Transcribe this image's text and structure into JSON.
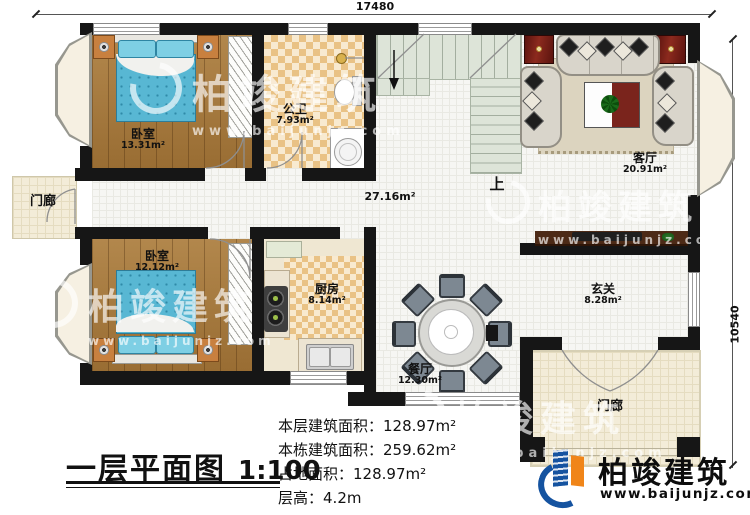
{
  "dimensions": {
    "top": "17480",
    "right": "10540"
  },
  "rooms": [
    {
      "name": "卧室",
      "area": "13.31m²"
    },
    {
      "name": "公卫",
      "area": "7.93m²"
    },
    {
      "name": "客厅",
      "area": "20.91m²"
    },
    {
      "name": "门廊",
      "area": ""
    },
    {
      "name": "卧室",
      "area": "12.12m²"
    },
    {
      "name": "厨房",
      "area": "8.14m²"
    },
    {
      "name": "餐厅",
      "area": "12.30m²"
    },
    {
      "name": "玄关",
      "area": "8.28m²"
    },
    {
      "name": "门廊",
      "area": ""
    },
    {
      "name": "",
      "area": "27.16m²"
    }
  ],
  "stairs": {
    "up_label": "上"
  },
  "title": {
    "text": "一层平面图",
    "scale": "1:100"
  },
  "info": [
    {
      "label": "本层建筑面积：",
      "value": "128.97m²"
    },
    {
      "label": "本栋建筑面积：",
      "value": "259.62m²"
    },
    {
      "label": "占地面积：",
      "value": "128.97m²"
    },
    {
      "label": "层高：",
      "value": "4.2m"
    }
  ],
  "brand": {
    "name": "柏竣建筑",
    "url": "www.baijunjz.com"
  },
  "watermark": {
    "name": "柏竣建筑",
    "url": "www.baijunjz.com"
  },
  "colors": {
    "wall": "#161616",
    "brand_blue": "#1553a0",
    "brand_orange": "#f08519",
    "wood": "#a87b3f",
    "stair": "#dce3d7",
    "checker": "#e9c285"
  }
}
